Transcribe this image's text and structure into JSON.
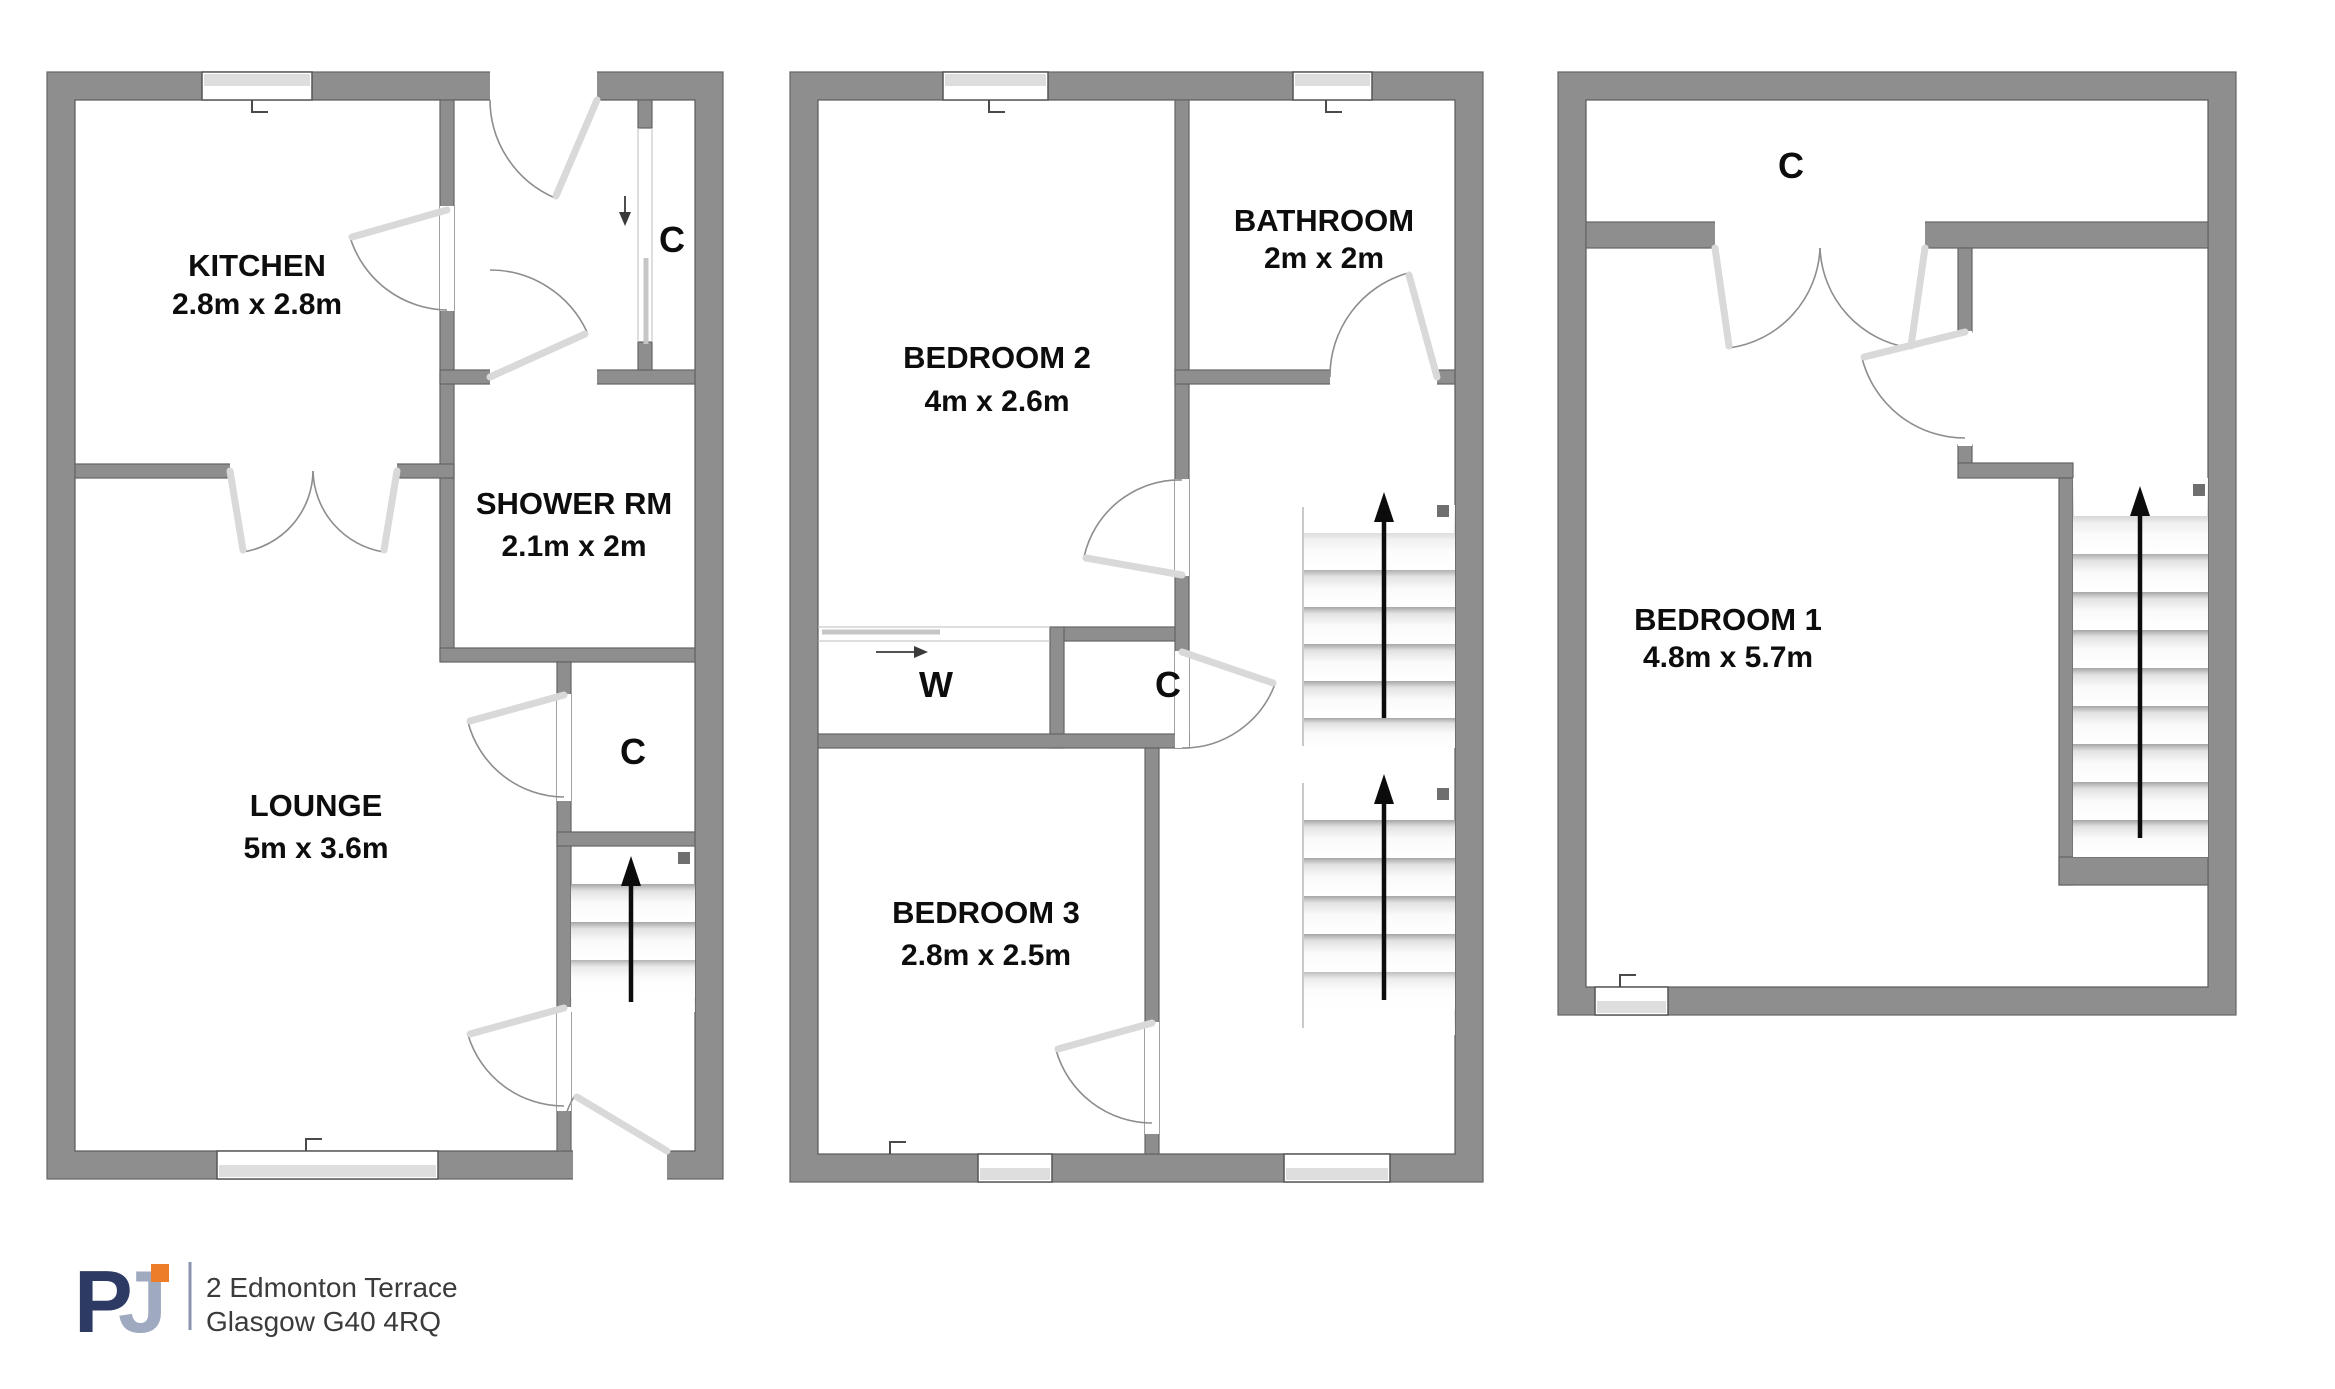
{
  "floors": {
    "ground": {
      "kitchen_name": "KITCHEN",
      "kitchen_dims": "2.8m x 2.8m",
      "shower_name": "SHOWER RM",
      "shower_dims": "2.1m x 2m",
      "lounge_name": "LOUNGE",
      "lounge_dims": "5m x 3.6m",
      "closet_hall": "C",
      "closet_stairs": "C"
    },
    "first": {
      "bedroom2_name": "BEDROOM 2",
      "bedroom2_dims": "4m x 2.6m",
      "bathroom_name": "BATHROOM",
      "bathroom_dims": "2m x 2m",
      "bedroom3_name": "BEDROOM 3",
      "bedroom3_dims": "2.8m x 2.5m",
      "wardrobe": "W",
      "closet": "C"
    },
    "second": {
      "closet": "C",
      "bedroom1_name": "BEDROOM 1",
      "bedroom1_dims": "4.8m x 5.7m"
    }
  },
  "footer": {
    "logo": {
      "letter1": "P",
      "letter2": "J"
    },
    "address_line1": "2 Edmonton Terrace",
    "address_line2": "Glasgow G40 4RQ"
  },
  "colors": {
    "wall": "#8e8e8e",
    "logo_navy": "#2d3a63",
    "logo_blue_gray": "#9fa9bf",
    "accent_orange": "#ee7d2a",
    "logo_divider": "#8a93b0"
  }
}
